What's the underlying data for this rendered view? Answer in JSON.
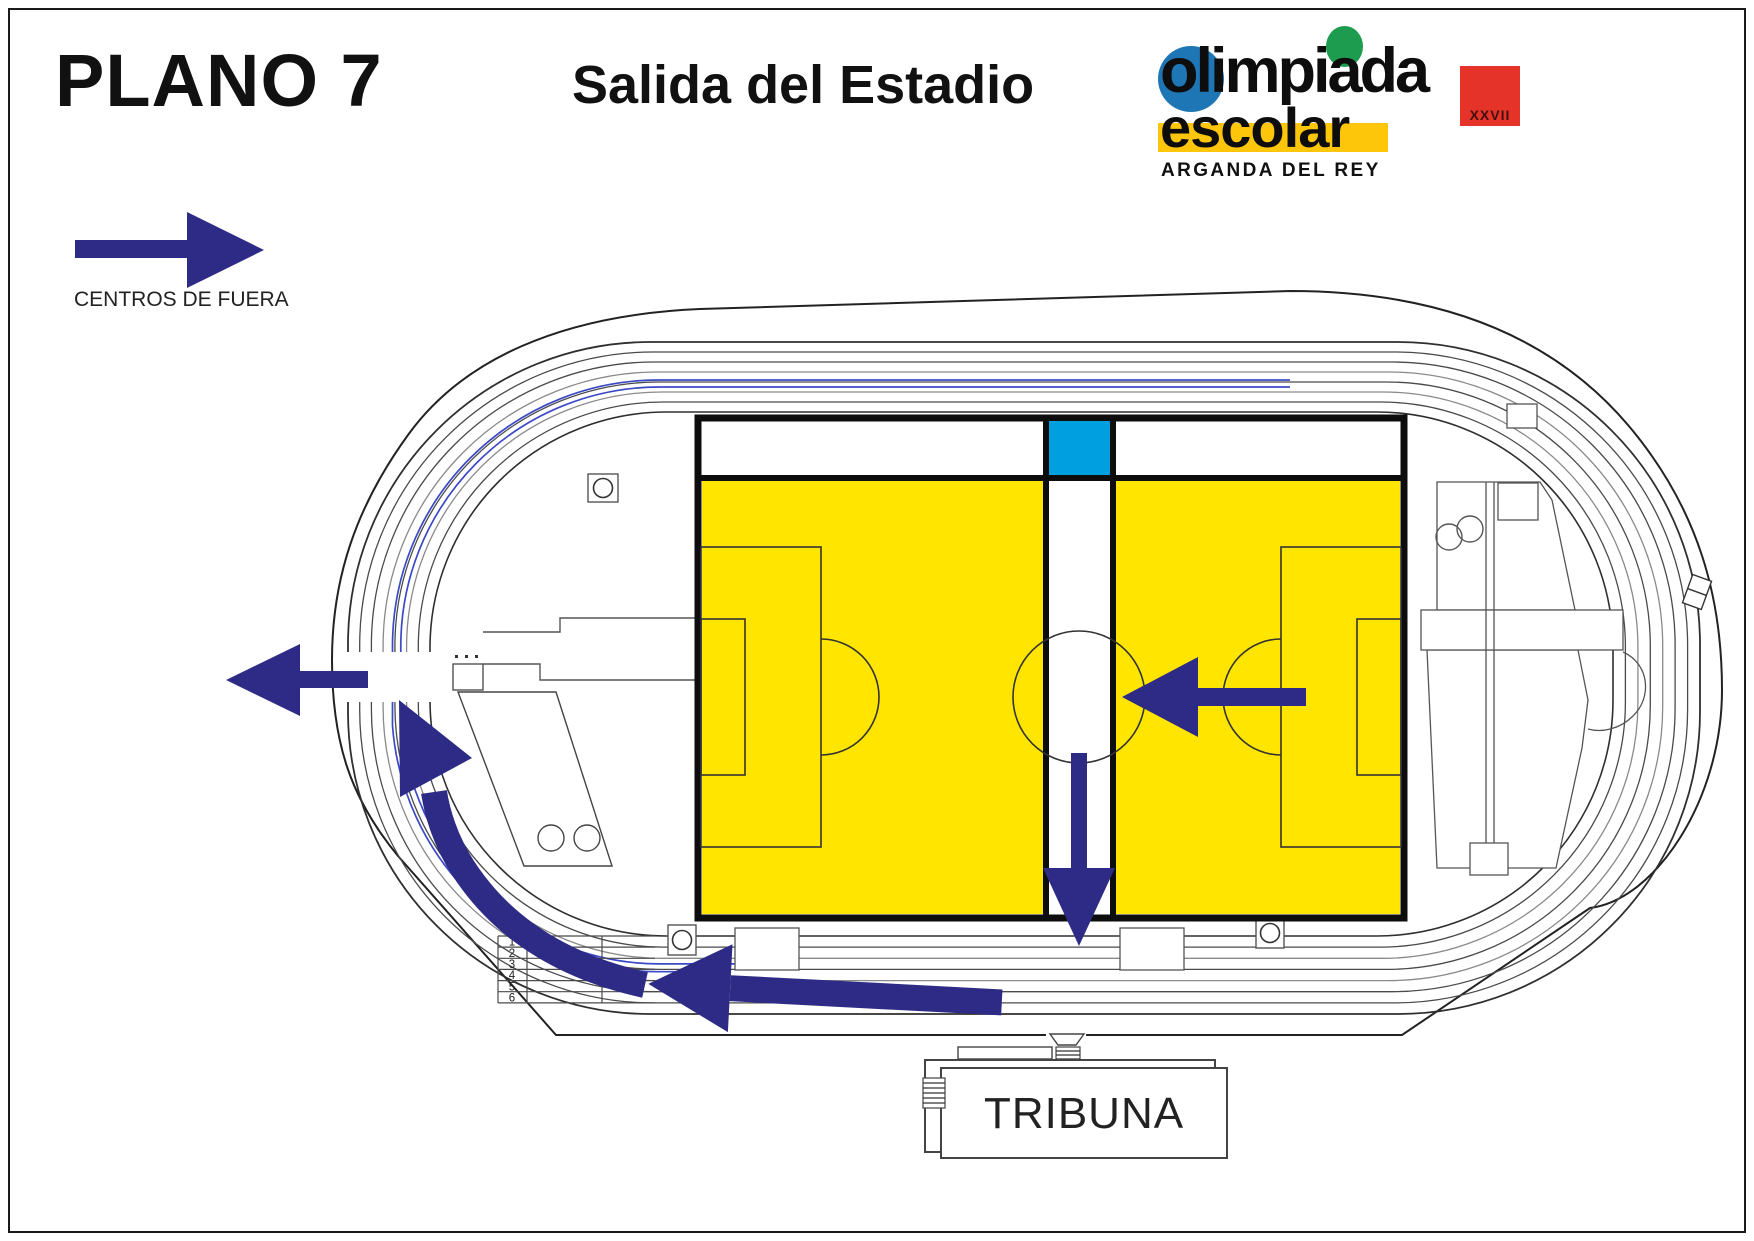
{
  "header": {
    "plan_title": "PLANO 7",
    "subtitle": "Salida del Estadio"
  },
  "logo": {
    "word1": "olimpiada",
    "word2": "escolar",
    "word3": "ARGANDA DEL REY",
    "edition": "XXVII",
    "blue": "#1f76b4",
    "green": "#1d9b4e",
    "red": "#e63329",
    "band_yellow": "#fdc60a"
  },
  "legend": {
    "label": "CENTROS DE FUERA"
  },
  "stadium": {
    "tribuna_label": "TRIBUNA",
    "lane_numbers": [
      "1",
      "2",
      "3",
      "4",
      "5",
      "6"
    ]
  },
  "colors": {
    "navy": "#2d2b85",
    "field_yellow": "#ffe500",
    "corridor_cyan": "#009fe0",
    "route_blue": "#3b4ac6"
  }
}
